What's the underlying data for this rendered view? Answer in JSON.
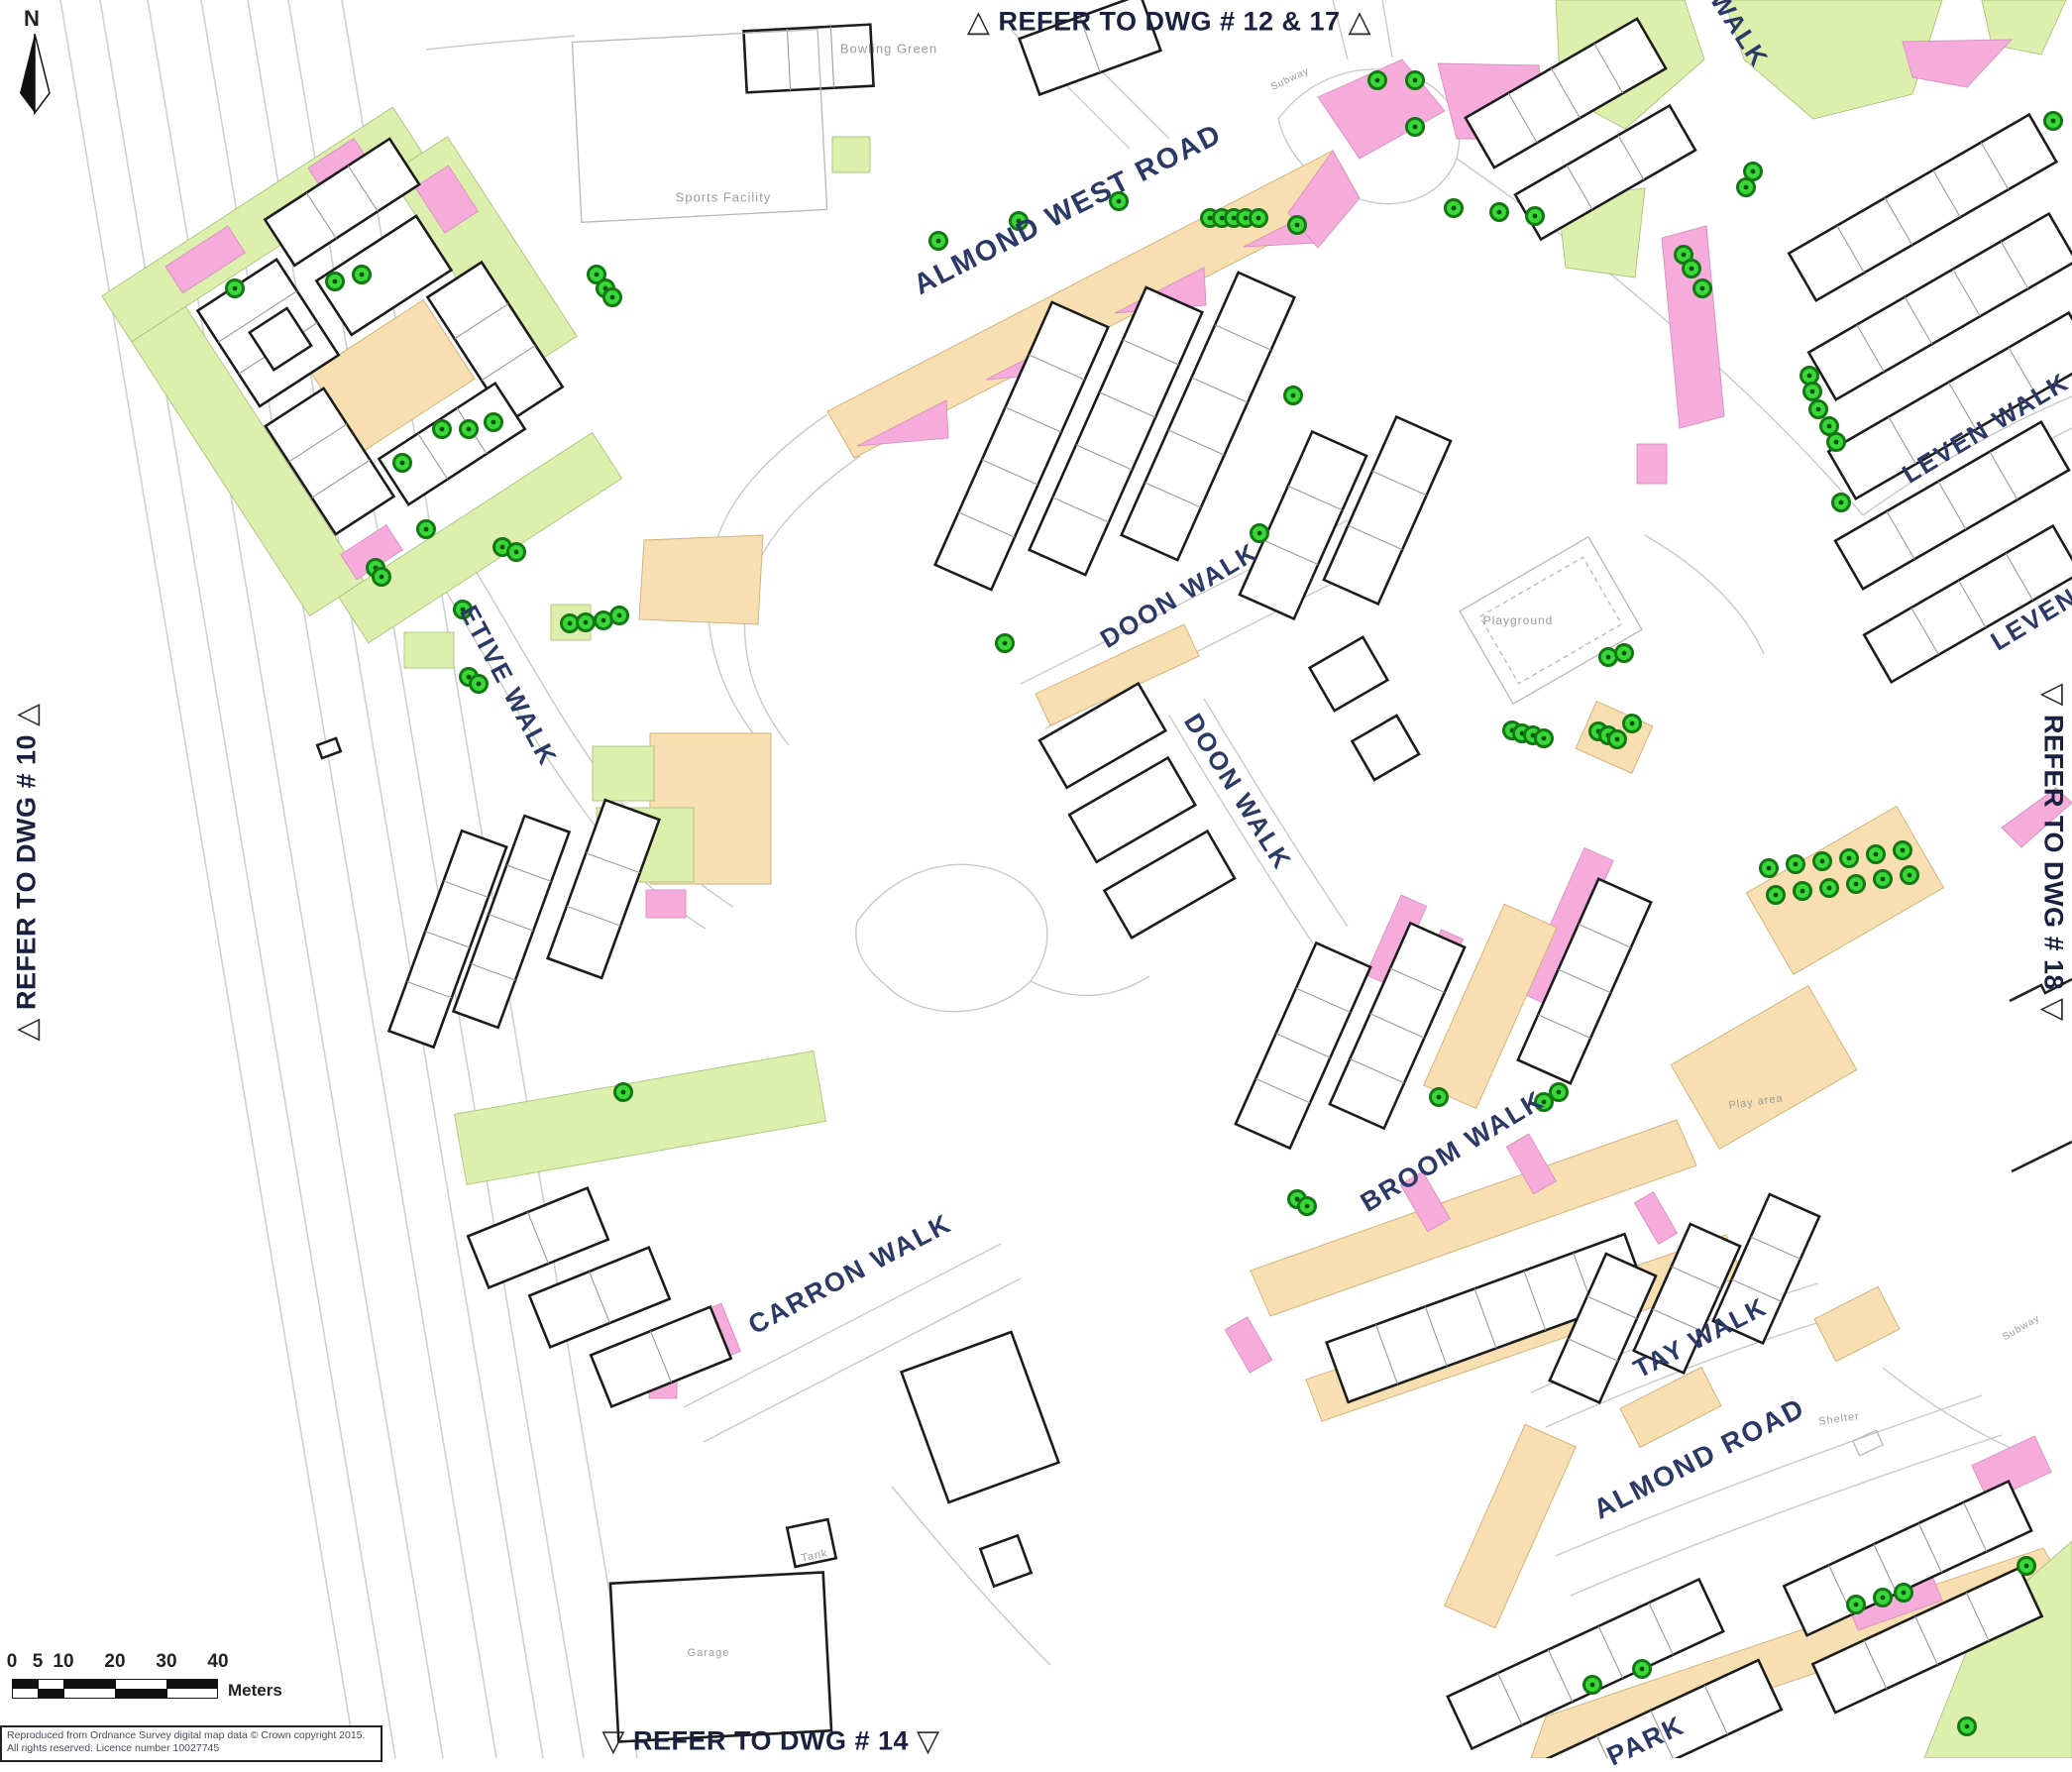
{
  "map": {
    "north_label": "N",
    "ref_labels": {
      "top": {
        "marker": "△",
        "text": "REFER TO DWG # 12 & 17"
      },
      "left": {
        "marker": "△",
        "text": "REFER TO DWG # 10"
      },
      "right": {
        "marker": "▽",
        "text": "REFER TO DWG # 18"
      },
      "bottom": {
        "marker": "▽",
        "text": "REFER TO DWG # 14"
      }
    },
    "street_labels": [
      {
        "text": "ALMOND WEST ROAD"
      },
      {
        "text": "DOON WALK"
      },
      {
        "text": "DOON WALK"
      },
      {
        "text": "ETIVE WALK"
      },
      {
        "text": "CARRON WALK"
      },
      {
        "text": "BROOM WALK"
      },
      {
        "text": "TAY WALK"
      },
      {
        "text": "ALMOND ROAD"
      },
      {
        "text": "LEVEN WALK"
      },
      {
        "text": "LEVEN"
      },
      {
        "text": "WALK"
      },
      {
        "text": "PARK"
      }
    ],
    "facility_labels": [
      {
        "text": "Bowling Green"
      },
      {
        "text": "Sports Facility"
      },
      {
        "text": "Playground"
      },
      {
        "text": "Shelter"
      },
      {
        "text": "Tank"
      },
      {
        "text": "Garage"
      },
      {
        "text": "Play area"
      },
      {
        "text": "Subway"
      },
      {
        "text": "Subway"
      }
    ],
    "scale_bar": {
      "ticks": [
        "0",
        "5",
        "10",
        "20",
        "30",
        "40"
      ],
      "unit": "Meters"
    },
    "copyright": {
      "line1": "Reproduced from Ordnance Survey digital map data © Crown copyright 2015.",
      "line2": "All rights reserved. Licence number 10027745"
    },
    "colors": {
      "parcel_pink": "#F5ACDB",
      "parcel_green": "#DCEFAD",
      "parcel_tan": "#F7DFB2",
      "tree_fill": "#38D838",
      "tree_ring": "#137813",
      "street_text": "#2B3966",
      "ref_text": "#1A2040"
    }
  }
}
